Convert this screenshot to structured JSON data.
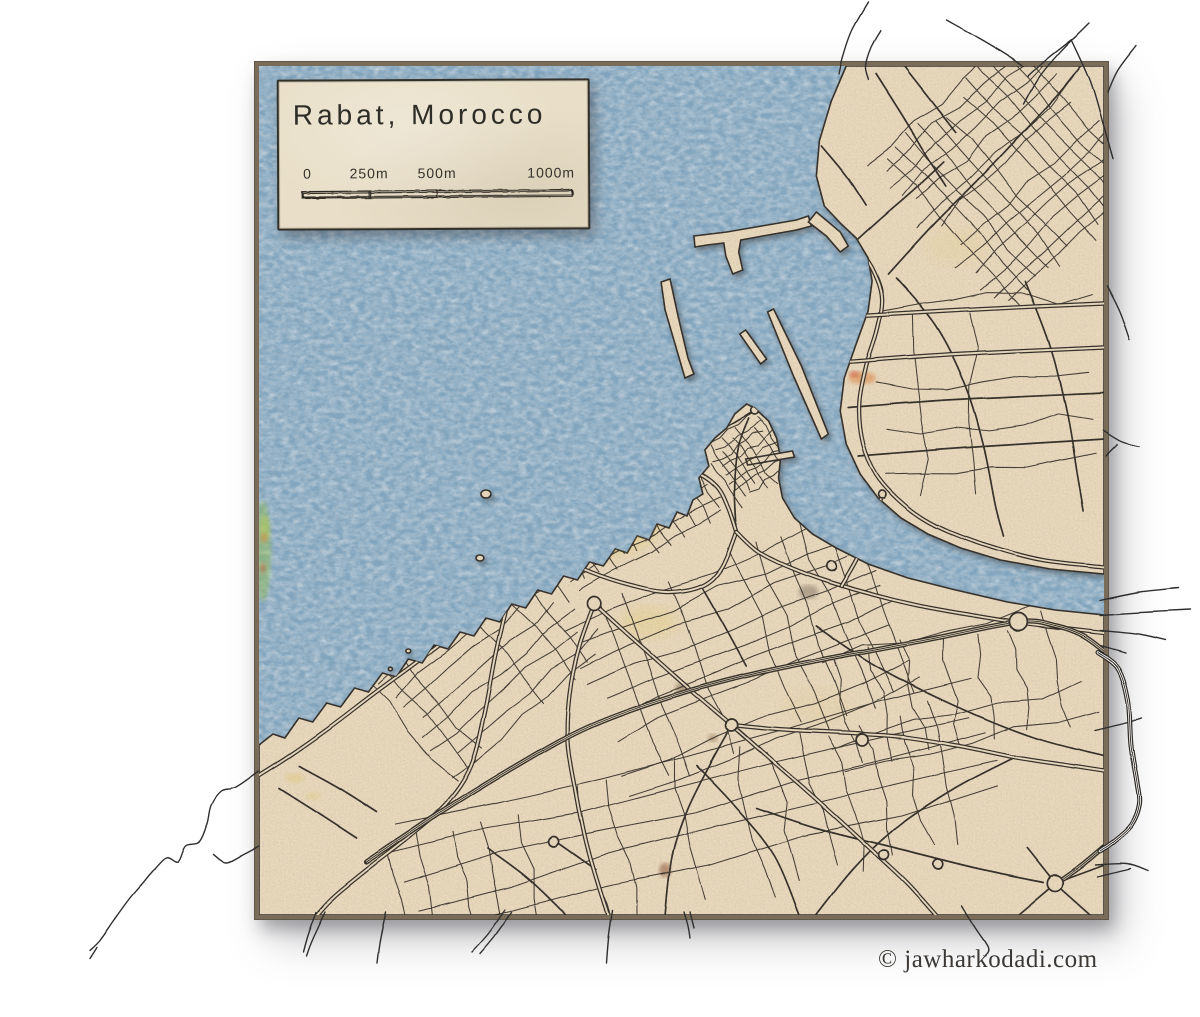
{
  "page": {
    "background_color": "#ffffff"
  },
  "map_card": {
    "title": "Rabat, Morocco"
  },
  "scale_bar": {
    "tick_0": "0",
    "tick_1": "250m",
    "tick_2": "500m",
    "tick_3": "1000m"
  },
  "attribution": {
    "text": "© jawharkodadi.com"
  },
  "palette": {
    "water": "#7ea6c4",
    "land": "#ecdcc0",
    "ink": "#2b2620",
    "frame_border": "#7a6c58",
    "card_bg": "#e9dfc8",
    "wash_yellow": "#e8cc52",
    "wash_orange": "#e0762c",
    "road_outside": "#2f2f2f"
  }
}
